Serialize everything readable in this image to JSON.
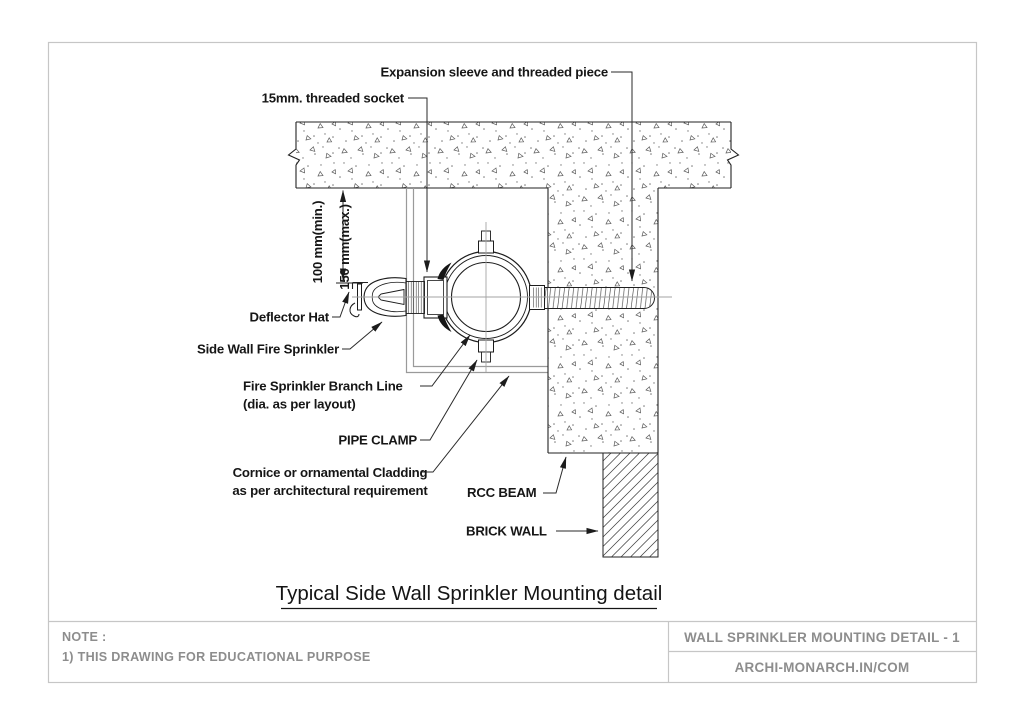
{
  "drawing": {
    "title": "Typical Side Wall Sprinkler Mounting detail",
    "labels": {
      "expansion_sleeve": "Expansion sleeve and threaded piece",
      "threaded_socket": "15mm. threaded socket",
      "dim_min": "100 mm(min.)",
      "dim_max": "150 mm(max.)",
      "deflector_hat": "Deflector Hat",
      "side_wall_sprinkler": "Side Wall Fire Sprinkler",
      "branch_line_1": "Fire Sprinkler Branch Line",
      "branch_line_2": "(dia. as per layout)",
      "pipe_clamp": "PIPE CLAMP",
      "cornice_1": "Cornice or ornamental Cladding",
      "cornice_2": "as per architectural requirement",
      "rcc_beam": "RCC BEAM",
      "brick_wall": "BRICK WALL"
    }
  },
  "title_block": {
    "note_heading": "NOTE :",
    "note_1": "1) THIS DRAWING FOR EDUCATIONAL PURPOSE",
    "sheet_title": "WALL SPRINKLER MOUNTING DETAIL - 1",
    "source": "ARCHI-MONARCH.IN/COM"
  },
  "colors": {
    "line": "#1f1f1f",
    "muted_text": "#8d8d8d",
    "border": "#c6c6c6",
    "centerline": "#a3a3a3",
    "cladding_line": "#9a9a9a"
  }
}
